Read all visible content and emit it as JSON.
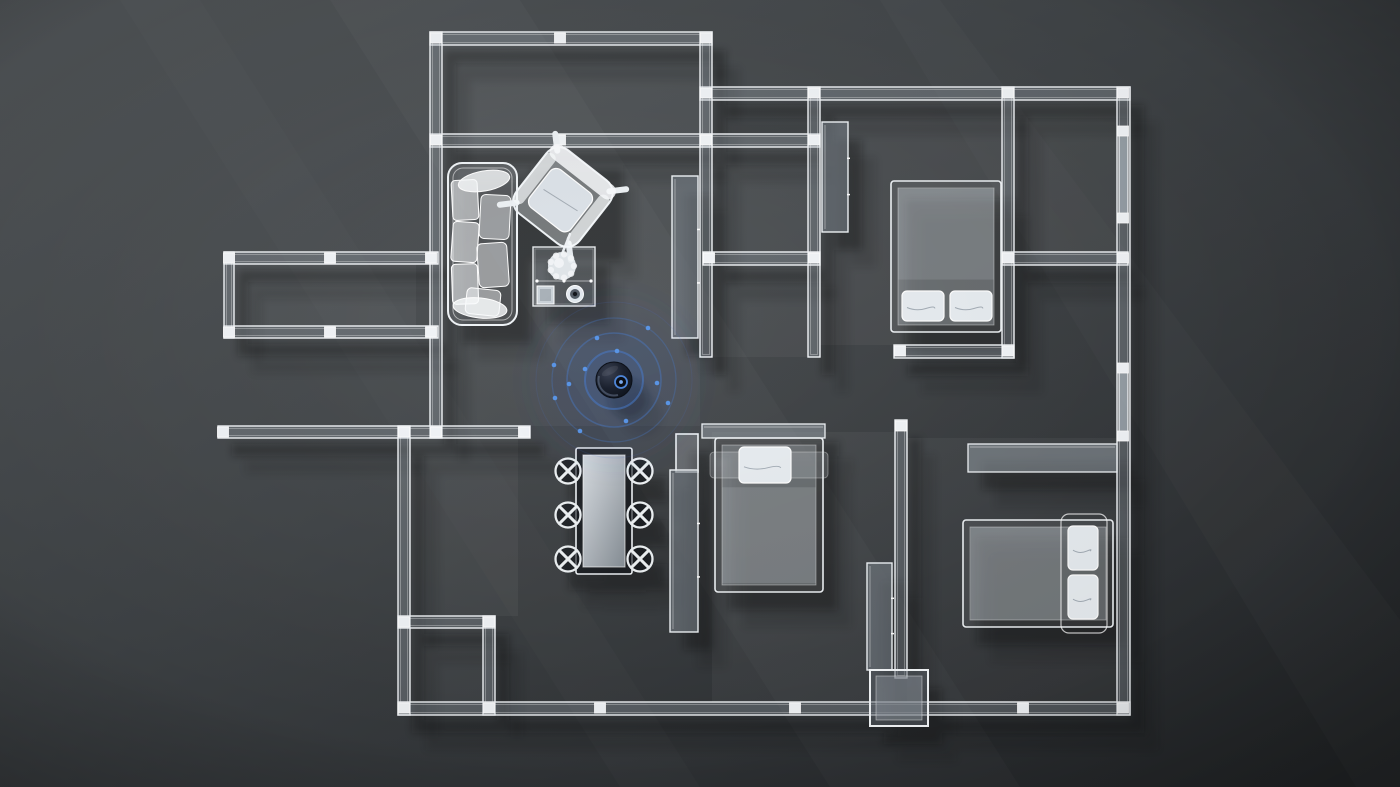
{
  "meta": {
    "description": "Top-down 3D wireframe floor plan of an apartment with a Wi-Fi router device broadcasting blue signal rings from the hallway"
  },
  "palette": {
    "bg_light": "#4e5255",
    "bg_mid": "#3d4144",
    "bg_dark": "#26292b",
    "wall_stroke": "#f4f7fa",
    "wall_fill": "rgba(170,180,190,0.30)",
    "window_fill": "rgba(205,218,228,0.50)",
    "floor_fill": "rgba(255,255,255,0.045)",
    "furniture_stroke": "#f0f4f7",
    "shadow": "#07090b",
    "accent_blue": "#4a7fd0",
    "dot_blue": "#5a95e6",
    "puck_dark": "#0a0e16"
  },
  "floorplan": {
    "canvas": {
      "w": 1400,
      "h": 787
    },
    "walls": [
      [
        430,
        32,
        282,
        13
      ],
      [
        430,
        134,
        390,
        13
      ],
      [
        700,
        87,
        430,
        13
      ],
      [
        430,
        32,
        12,
        406
      ],
      [
        700,
        32,
        12,
        115
      ],
      [
        700,
        134,
        12,
        223
      ],
      [
        808,
        87,
        12,
        270
      ],
      [
        1002,
        87,
        12,
        271
      ],
      [
        1117,
        87,
        13,
        628
      ],
      [
        703,
        252,
        117,
        13
      ],
      [
        1002,
        252,
        126,
        13
      ],
      [
        894,
        345,
        120,
        13
      ],
      [
        224,
        252,
        214,
        12
      ],
      [
        224,
        326,
        214,
        12
      ],
      [
        224,
        252,
        10,
        86
      ],
      [
        218,
        426,
        312,
        12
      ],
      [
        398,
        426,
        12,
        289
      ],
      [
        398,
        616,
        97,
        12
      ],
      [
        483,
        616,
        12,
        99
      ],
      [
        398,
        702,
        732,
        13
      ],
      [
        895,
        420,
        12,
        258
      ]
    ],
    "windows": [
      [
        1119,
        129,
        9,
        90
      ],
      [
        1119,
        369,
        9,
        68
      ]
    ],
    "posts": [
      [
        436,
        38
      ],
      [
        560,
        38
      ],
      [
        706,
        38
      ],
      [
        436,
        140
      ],
      [
        560,
        140
      ],
      [
        706,
        140
      ],
      [
        814,
        140
      ],
      [
        706,
        93
      ],
      [
        814,
        93
      ],
      [
        1008,
        93
      ],
      [
        1123,
        93
      ],
      [
        709,
        258
      ],
      [
        814,
        258
      ],
      [
        1008,
        258
      ],
      [
        1123,
        258
      ],
      [
        900,
        351
      ],
      [
        1008,
        351
      ],
      [
        229,
        258
      ],
      [
        330,
        258
      ],
      [
        431,
        258
      ],
      [
        229,
        332
      ],
      [
        330,
        332
      ],
      [
        431,
        332
      ],
      [
        223,
        432
      ],
      [
        404,
        432
      ],
      [
        436,
        432
      ],
      [
        524,
        432
      ],
      [
        404,
        622
      ],
      [
        489,
        622
      ],
      [
        404,
        708
      ],
      [
        489,
        708
      ],
      [
        600,
        708
      ],
      [
        795,
        708
      ],
      [
        1023,
        708
      ],
      [
        1123,
        708
      ],
      [
        1123,
        131
      ],
      [
        1123,
        218
      ],
      [
        1123,
        368
      ],
      [
        1123,
        436
      ],
      [
        901,
        426
      ]
    ],
    "rooms": [
      {
        "name": "balcony-top",
        "x": 442,
        "y": 45,
        "w": 258,
        "h": 89
      },
      {
        "name": "living-room",
        "x": 442,
        "y": 147,
        "w": 258,
        "h": 279
      },
      {
        "name": "hall-closet",
        "x": 712,
        "y": 147,
        "w": 96,
        "h": 105
      },
      {
        "name": "storage",
        "x": 712,
        "y": 265,
        "w": 96,
        "h": 92
      },
      {
        "name": "bedroom-top-right",
        "x": 820,
        "y": 100,
        "w": 182,
        "h": 245
      },
      {
        "name": "bathroom",
        "x": 1014,
        "y": 100,
        "w": 103,
        "h": 152
      },
      {
        "name": "balcony-left",
        "x": 234,
        "y": 264,
        "w": 182,
        "h": 62
      },
      {
        "name": "kitchen",
        "x": 410,
        "y": 438,
        "w": 108,
        "h": 178
      },
      {
        "name": "utility-nook",
        "x": 410,
        "y": 628,
        "w": 73,
        "h": 74
      },
      {
        "name": "bedroom-center",
        "x": 712,
        "y": 432,
        "w": 183,
        "h": 270
      },
      {
        "name": "bedroom-bottom-right",
        "x": 907,
        "y": 438,
        "w": 210,
        "h": 264
      }
    ],
    "furniture": [
      {
        "type": "sofa",
        "name": "sofa",
        "x": 448,
        "y": 163,
        "w": 69,
        "h": 162
      },
      {
        "type": "armchair",
        "name": "armchair",
        "cx": 563,
        "cy": 197,
        "size": 80,
        "rot": 38
      },
      {
        "type": "floor-lamp",
        "name": "floor-lamp",
        "cx": 562,
        "cy": 266,
        "r": 14
      },
      {
        "type": "coffee-table",
        "name": "coffee-table",
        "x": 533,
        "y": 247,
        "w": 62,
        "h": 59
      },
      {
        "type": "dining-table",
        "name": "dining-table",
        "x": 576,
        "y": 448,
        "w": 56,
        "h": 126
      },
      {
        "type": "chair",
        "name": "dining-chair",
        "cx": 568,
        "cy": 471
      },
      {
        "type": "chair",
        "name": "dining-chair",
        "cx": 568,
        "cy": 515
      },
      {
        "type": "chair",
        "name": "dining-chair",
        "cx": 568,
        "cy": 559
      },
      {
        "type": "chair",
        "name": "dining-chair",
        "cx": 640,
        "cy": 471
      },
      {
        "type": "chair",
        "name": "dining-chair",
        "cx": 640,
        "cy": 515
      },
      {
        "type": "chair",
        "name": "dining-chair",
        "cx": 640,
        "cy": 559
      },
      {
        "type": "cabinet",
        "name": "tv-cabinet",
        "x": 672,
        "y": 176,
        "w": 26,
        "h": 162
      },
      {
        "type": "cabinet",
        "name": "dresser",
        "x": 822,
        "y": 122,
        "w": 26,
        "h": 110
      },
      {
        "type": "bed",
        "name": "bed-top-right",
        "x": 891,
        "y": 181,
        "w": 110,
        "h": 151,
        "orient": "v",
        "pillowEnd": "bottom",
        "pillows": 2
      },
      {
        "type": "slab",
        "name": "headboard-shelf",
        "x": 702,
        "y": 424,
        "w": 123,
        "h": 14
      },
      {
        "type": "bed",
        "name": "bed-center",
        "x": 715,
        "y": 438,
        "w": 108,
        "h": 154,
        "orient": "v",
        "pillowEnd": "top",
        "pillows": 1
      },
      {
        "type": "minibox",
        "name": "door-leaf",
        "x": 676,
        "y": 434,
        "w": 22,
        "h": 38
      },
      {
        "type": "cabinet",
        "name": "wardrobe",
        "x": 670,
        "y": 470,
        "w": 28,
        "h": 162
      },
      {
        "type": "cabinet",
        "name": "side-cabinet",
        "x": 867,
        "y": 563,
        "w": 25,
        "h": 107
      },
      {
        "type": "utilitybox",
        "name": "utility-box",
        "x": 870,
        "y": 670,
        "w": 58,
        "h": 56
      },
      {
        "type": "slab",
        "name": "desk",
        "x": 968,
        "y": 444,
        "w": 149,
        "h": 28
      },
      {
        "type": "bed",
        "name": "bed-bottom-right",
        "x": 963,
        "y": 520,
        "w": 150,
        "h": 107,
        "orient": "h",
        "pillowEnd": "right",
        "pillows": 2
      }
    ],
    "device": {
      "name": "wifi-router",
      "cx": 614,
      "cy": 380,
      "r": 18,
      "lens": {
        "cx": 621,
        "cy": 382,
        "r": 6
      },
      "rings": [
        {
          "r": 29,
          "sw": 2.0,
          "so": 0.55,
          "fo": 0.2
        },
        {
          "r": 47,
          "sw": 1.6,
          "so": 0.42,
          "fo": 0.1
        },
        {
          "r": 62,
          "sw": 1.3,
          "so": 0.3,
          "fo": 0.05
        },
        {
          "r": 78,
          "sw": 1.0,
          "so": 0.13,
          "fo": 0.0
        }
      ],
      "dots": [
        [
          648,
          328
        ],
        [
          597,
          338
        ],
        [
          617,
          351
        ],
        [
          554,
          365
        ],
        [
          585,
          369
        ],
        [
          569,
          384
        ],
        [
          555,
          398
        ],
        [
          657,
          383
        ],
        [
          668,
          403
        ],
        [
          626,
          421
        ],
        [
          580,
          431
        ]
      ]
    }
  }
}
